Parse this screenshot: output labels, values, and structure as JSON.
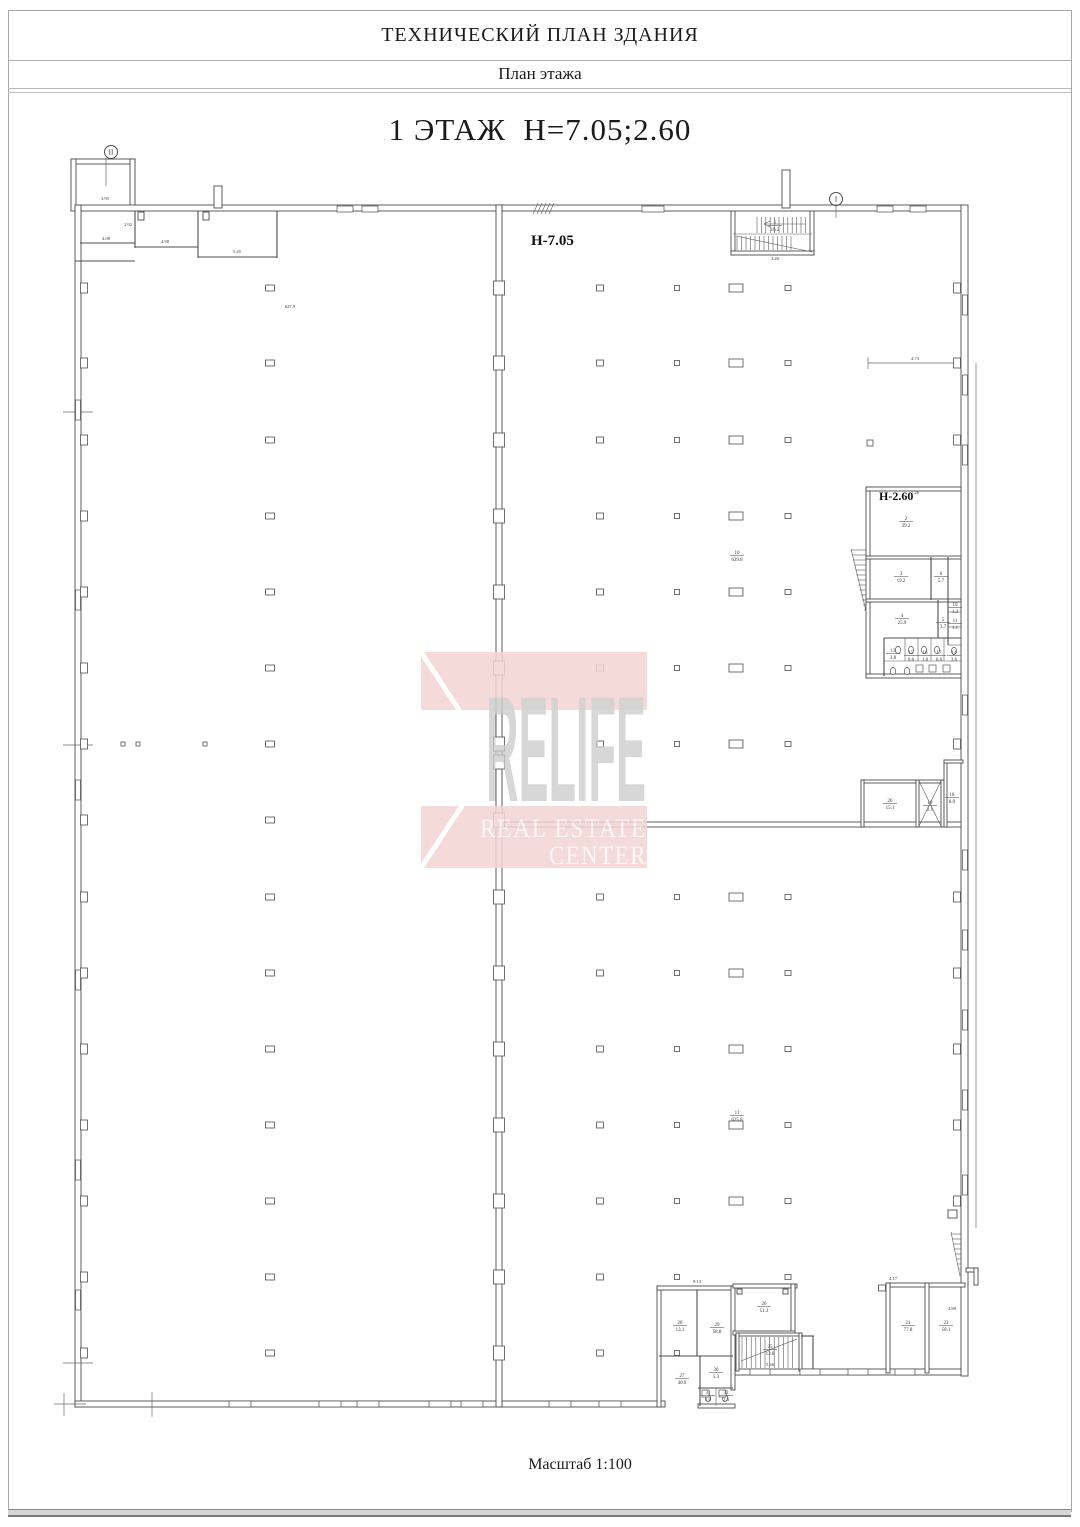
{
  "header": {
    "title": "ТЕХНИЧЕСКИЙ ПЛАН ЗДАНИЯ",
    "subtitle": "План этажа"
  },
  "floor_title": "1 ЭТАЖ  Н=7.05;2.60",
  "scale_note": "Масштаб 1:100",
  "watermark": {
    "brand": "RELIFE",
    "line1": "REAL ESTATE",
    "line2": "CENTER",
    "pink": "#f3d4d3",
    "letter_gray": "#cbcbcb"
  },
  "plan": {
    "h_labels": [
      {
        "x": 531,
        "y": 245,
        "t": "Н-7.05",
        "size": 15
      },
      {
        "x": 879,
        "y": 500,
        "t": "Н-2.60",
        "size": 12
      }
    ],
    "markers": [
      {
        "x": 111,
        "y": 152,
        "label": "II"
      },
      {
        "x": 836,
        "y": 199,
        "label": "I"
      }
    ],
    "room_labels": [
      {
        "x": 737,
        "y": 554,
        "num": "10",
        "area": "639.8"
      },
      {
        "x": 737,
        "y": 1114,
        "num": "11",
        "area": "625.8"
      },
      {
        "x": 775,
        "y": 224,
        "num": "1",
        "area": "16.2"
      },
      {
        "x": 906,
        "y": 520,
        "num": "2",
        "area": "39.2"
      },
      {
        "x": 901,
        "y": 575,
        "num": "3",
        "area": "19.2"
      },
      {
        "x": 941,
        "y": 575,
        "num": "6",
        "area": "5.7"
      },
      {
        "x": 902,
        "y": 617,
        "num": "4",
        "area": "25.9"
      },
      {
        "x": 943,
        "y": 621,
        "num": "5",
        "area": "3.7"
      },
      {
        "x": 955,
        "y": 606,
        "num": "10",
        "area": "1.2"
      },
      {
        "x": 955,
        "y": 622,
        "num": "11",
        "area": "1.1"
      },
      {
        "x": 893,
        "y": 652,
        "num": "13",
        "area": "3.8"
      },
      {
        "x": 911,
        "y": 654,
        "num": "15",
        "area": "0.6"
      },
      {
        "x": 925,
        "y": 654,
        "num": "16",
        "area": "1.0"
      },
      {
        "x": 939,
        "y": 654,
        "num": "17",
        "area": "0.6"
      },
      {
        "x": 954,
        "y": 654,
        "num": "14",
        "area": "3.6"
      },
      {
        "x": 890,
        "y": 802,
        "num": "20",
        "area": "15.1"
      },
      {
        "x": 930,
        "y": 804,
        "num": "19",
        "area": "2.1"
      },
      {
        "x": 952,
        "y": 796,
        "num": "18",
        "area": "8.0"
      },
      {
        "x": 680,
        "y": 1324,
        "num": "28",
        "area": "13.1"
      },
      {
        "x": 717,
        "y": 1326,
        "num": "29",
        "area": "58.8"
      },
      {
        "x": 764,
        "y": 1305,
        "num": "26",
        "area": "51.3"
      },
      {
        "x": 770,
        "y": 1348,
        "num": "25",
        "area": "13.8"
      },
      {
        "x": 682,
        "y": 1377,
        "num": "27",
        "area": "40.9"
      },
      {
        "x": 716,
        "y": 1371,
        "num": "30",
        "area": "5.3"
      },
      {
        "x": 708,
        "y": 1394,
        "num": "31",
        "area": "1.0"
      },
      {
        "x": 726,
        "y": 1394,
        "num": "32",
        "area": "2.6"
      },
      {
        "x": 908,
        "y": 1324,
        "num": "21",
        "area": "77.8"
      },
      {
        "x": 946,
        "y": 1324,
        "num": "23",
        "area": "58.1"
      }
    ],
    "dim_labels": [
      {
        "x": 290,
        "y": 308,
        "t": "627.9"
      },
      {
        "x": 105,
        "y": 200,
        "t": "3.95"
      },
      {
        "x": 106,
        "y": 240,
        "t": "4.08"
      },
      {
        "x": 165,
        "y": 243,
        "t": "4.90"
      },
      {
        "x": 237,
        "y": 253,
        "t": "5.45"
      },
      {
        "x": 128,
        "y": 226,
        "t": "2.92"
      },
      {
        "x": 775,
        "y": 260,
        "t": "4.40"
      },
      {
        "x": 915,
        "y": 360,
        "t": "4.73"
      },
      {
        "x": 915,
        "y": 494,
        "t": "7.26"
      },
      {
        "x": 697,
        "y": 1283,
        "t": "9.13"
      },
      {
        "x": 770,
        "y": 1366,
        "t": "5.46"
      },
      {
        "x": 893,
        "y": 1280,
        "t": "4.17"
      },
      {
        "x": 952,
        "y": 1310,
        "t": "2.89"
      }
    ],
    "columns": [
      {
        "x": 270,
        "w": 9,
        "h": 6,
        "ys": [
          288,
          363,
          440,
          516,
          592,
          668,
          744,
          820,
          897,
          973,
          1049,
          1125,
          1201,
          1277,
          1353
        ]
      },
      {
        "x": 600,
        "w": 7,
        "h": 6,
        "ys": [
          288,
          363,
          440,
          516,
          592,
          668,
          744,
          897,
          973,
          1049,
          1125,
          1201,
          1277,
          1353
        ]
      },
      {
        "x": 677,
        "w": 5,
        "h": 5,
        "ys": [
          288,
          363,
          440,
          516,
          592,
          668,
          744,
          897,
          973,
          1049,
          1125,
          1201,
          1277,
          1353
        ]
      },
      {
        "x": 736,
        "w": 14,
        "h": 8,
        "ys": [
          288,
          363,
          440,
          516,
          592,
          668,
          744,
          897,
          973,
          1049,
          1125,
          1201
        ]
      },
      {
        "x": 788,
        "w": 6,
        "h": 5,
        "ys": [
          288,
          363,
          440,
          516,
          592,
          668,
          744,
          897,
          973,
          1049,
          1125,
          1201,
          1277
        ]
      },
      {
        "x": 499,
        "w": 11,
        "h": 14,
        "ys": [
          288,
          363,
          440,
          516,
          592,
          668,
          744,
          762,
          820,
          897,
          973,
          1049,
          1125,
          1201,
          1277,
          1353
        ]
      },
      {
        "x": 84,
        "w": 7,
        "h": 10,
        "ys": [
          288,
          363,
          440,
          516,
          592,
          668,
          744,
          820,
          897,
          973,
          1049,
          1125,
          1201,
          1277,
          1353
        ]
      },
      {
        "x": 957,
        "w": 7,
        "h": 10,
        "ys": [
          288,
          363,
          440,
          744,
          897,
          973,
          1049,
          1125,
          1201
        ]
      },
      {
        "x": 123,
        "w": 4,
        "h": 4,
        "ys": [
          744
        ]
      },
      {
        "x": 138,
        "w": 4,
        "h": 4,
        "ys": [
          744
        ]
      },
      {
        "x": 205,
        "w": 4,
        "h": 4,
        "ys": [
          744
        ]
      },
      {
        "x": 870,
        "w": 6,
        "h": 6,
        "ys": [
          443
        ]
      },
      {
        "x": 882,
        "w": 7,
        "h": 6,
        "ys": [
          1288
        ]
      }
    ],
    "windows": [
      {
        "x": 229,
        "y": 1401,
        "w": 22,
        "h": 6
      },
      {
        "x": 319,
        "y": 1401,
        "w": 22,
        "h": 6
      },
      {
        "x": 357,
        "y": 1401,
        "w": 22,
        "h": 6
      },
      {
        "x": 429,
        "y": 1401,
        "w": 22,
        "h": 6
      },
      {
        "x": 461,
        "y": 1401,
        "w": 22,
        "h": 6
      },
      {
        "x": 549,
        "y": 1401,
        "w": 22,
        "h": 6
      },
      {
        "x": 599,
        "y": 1401,
        "w": 22,
        "h": 6
      },
      {
        "x": 750,
        "y": 1369,
        "w": 20,
        "h": 6
      },
      {
        "x": 800,
        "y": 1369,
        "w": 20,
        "h": 6
      },
      {
        "x": 848,
        "y": 1369,
        "w": 20,
        "h": 6
      },
      {
        "x": 895,
        "y": 1369,
        "w": 20,
        "h": 6
      },
      {
        "x": 75.5,
        "y": 400,
        "w": 5,
        "h": 20
      },
      {
        "x": 75.5,
        "y": 590,
        "w": 5,
        "h": 20
      },
      {
        "x": 75.5,
        "y": 780,
        "w": 5,
        "h": 20
      },
      {
        "x": 75.5,
        "y": 970,
        "w": 5,
        "h": 20
      },
      {
        "x": 75.5,
        "y": 1160,
        "w": 5,
        "h": 20
      },
      {
        "x": 75.5,
        "y": 1290,
        "w": 5,
        "h": 20
      },
      {
        "x": 962.5,
        "y": 295,
        "w": 5,
        "h": 20
      },
      {
        "x": 962.5,
        "y": 375,
        "w": 5,
        "h": 20
      },
      {
        "x": 962.5,
        "y": 445,
        "w": 5,
        "h": 20
      },
      {
        "x": 962.5,
        "y": 695,
        "w": 5,
        "h": 20
      },
      {
        "x": 962.5,
        "y": 850,
        "w": 5,
        "h": 20
      },
      {
        "x": 962.5,
        "y": 930,
        "w": 5,
        "h": 20
      },
      {
        "x": 962.5,
        "y": 1010,
        "w": 5,
        "h": 20
      },
      {
        "x": 962.5,
        "y": 1090,
        "w": 5,
        "h": 20
      },
      {
        "x": 962.5,
        "y": 1175,
        "w": 5,
        "h": 20
      },
      {
        "x": 337,
        "y": 206,
        "w": 16,
        "h": 6
      },
      {
        "x": 362,
        "y": 206,
        "w": 16,
        "h": 6
      },
      {
        "x": 642,
        "y": 206,
        "w": 22,
        "h": 6
      },
      {
        "x": 877,
        "y": 206,
        "w": 16,
        "h": 6
      },
      {
        "x": 910,
        "y": 206,
        "w": 16,
        "h": 6
      }
    ],
    "fixtures": {
      "wc": [
        [
          898,
          650
        ],
        [
          911,
          650
        ],
        [
          924,
          650
        ],
        [
          937,
          650
        ],
        [
          954,
          651
        ],
        [
          708,
          1398
        ],
        [
          725,
          1398
        ],
        [
          893,
          671
        ],
        [
          907,
          671
        ]
      ],
      "sinks": [
        [
          916,
          665
        ],
        [
          929,
          665
        ],
        [
          943,
          665
        ],
        [
          702,
          1390
        ],
        [
          719,
          1390
        ]
      ]
    },
    "stairs": [
      {
        "type": "treads",
        "x0": 757,
        "x1": 809,
        "y0": 217,
        "y1": 233,
        "step": 4.4
      },
      {
        "type": "treads",
        "x0": 737,
        "x1": 791,
        "y0": 236,
        "y1": 250,
        "step": 4.5
      },
      {
        "type": "treads",
        "x0": 742,
        "x1": 797,
        "y0": 1337,
        "y1": 1368,
        "step": 4.6
      },
      {
        "type": "hsteps",
        "y0": 550,
        "y1": 610,
        "xw": 866,
        "xd0": 851,
        "xd1": 864,
        "step": 5
      },
      {
        "type": "hsteps",
        "y0": 1234,
        "y1": 1274,
        "xw": 961,
        "xd0": 951,
        "xd1": 960,
        "step": 5
      }
    ]
  }
}
